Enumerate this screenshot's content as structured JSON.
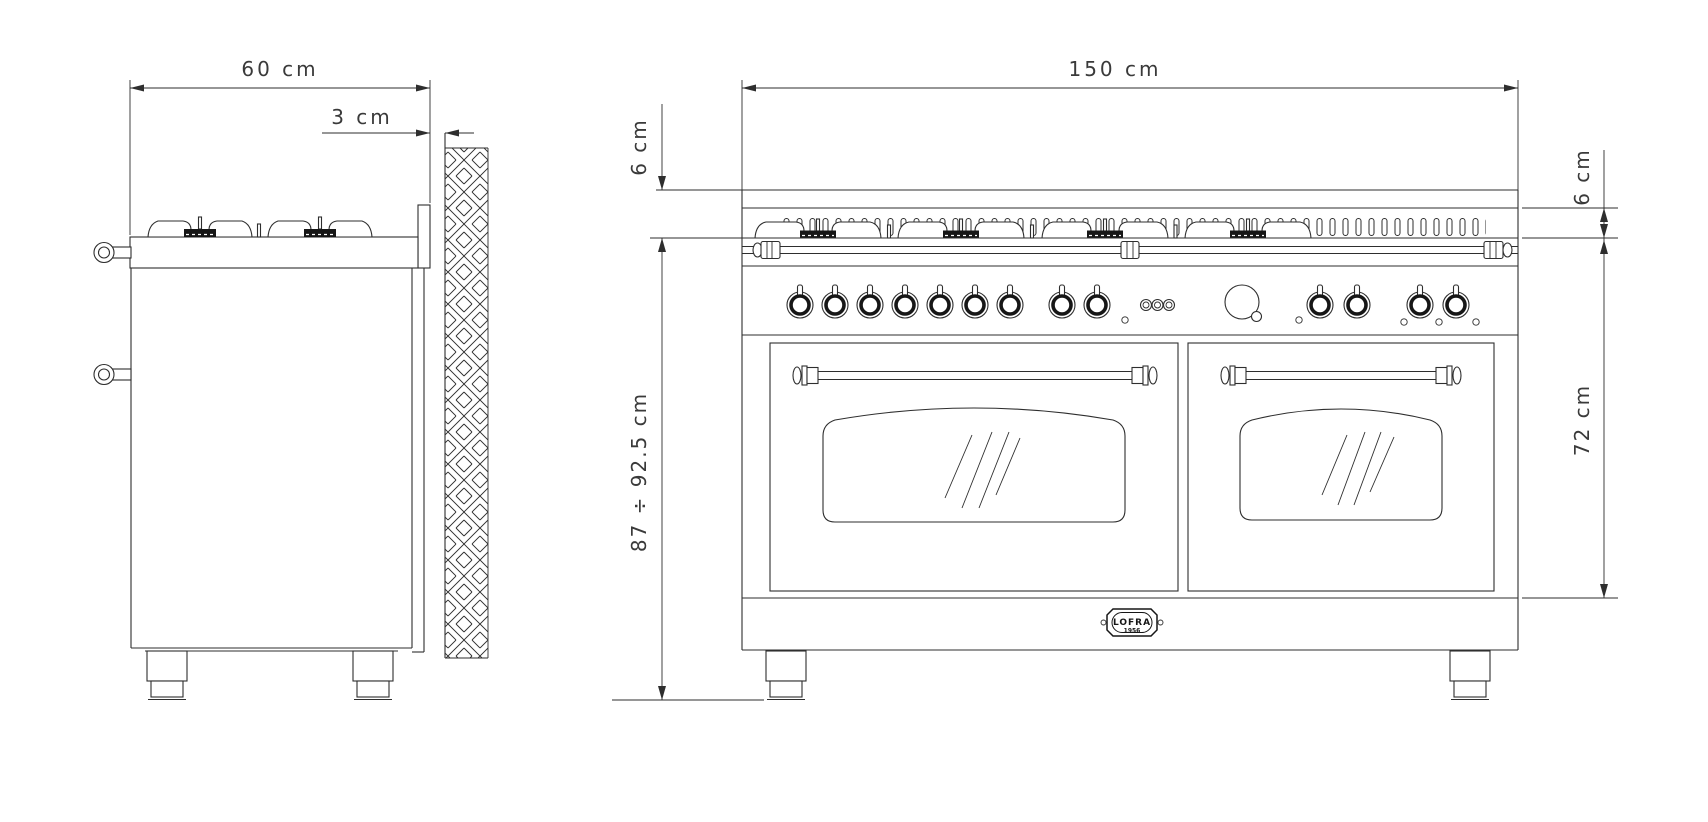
{
  "page": {
    "background": "#ffffff",
    "line_color": "#2e2e2e"
  },
  "drawing": {
    "title": "Range cooker installation drawing — side and front elevations",
    "side_view": {
      "depth_dim": "60 cm",
      "wall_gap_dim": "3 cm"
    },
    "front_view": {
      "width_dim": "150 cm",
      "backguard_dim_left": "6 cm",
      "backguard_dim_right": "6 cm",
      "worktop_height_dim": "87 ÷ 92.5 cm",
      "oven_front_height_dim": "72 cm",
      "badge_brand": "LOFRA",
      "badge_year": "1956"
    }
  }
}
